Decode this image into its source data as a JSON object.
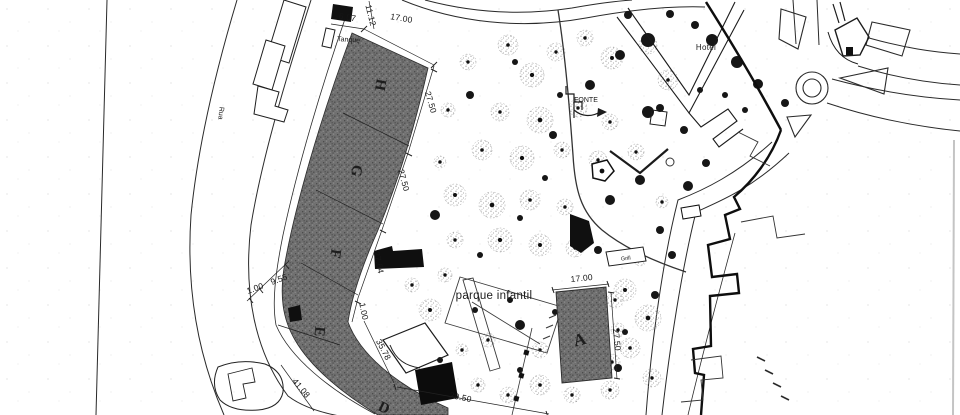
{
  "plan": {
    "street_label": "Rua",
    "tank_label": "Tanque",
    "hotel_label": "Hotel",
    "fountain_label": "FONTE",
    "playground_label": "parque infantil",
    "grill_label": "Grill",
    "plots": {
      "a": "A",
      "d": "D",
      "e": "E",
      "f": "F",
      "g": "G",
      "h": "H"
    },
    "dimensions": {
      "d_6_07": "6.07",
      "d_11_12": "11.12",
      "d_17_00_top": "17.00",
      "d_27_50_h": "27.50",
      "d_27_50_g": "27.50",
      "d_27_64_f": "27.64",
      "d_9_55": "9.55",
      "d_1_00_left": "1.00",
      "d_1_00_right": "1.00",
      "d_35_78": "35.78",
      "d_41_08": "41.08",
      "d_29_50": "29.50",
      "d_17_00_a": "17.00",
      "d_27_50_a": "27.50"
    },
    "colors": {
      "ink": "#1a1a1a",
      "hatch": "#6f6f6f",
      "paper": "#ffffff"
    }
  }
}
